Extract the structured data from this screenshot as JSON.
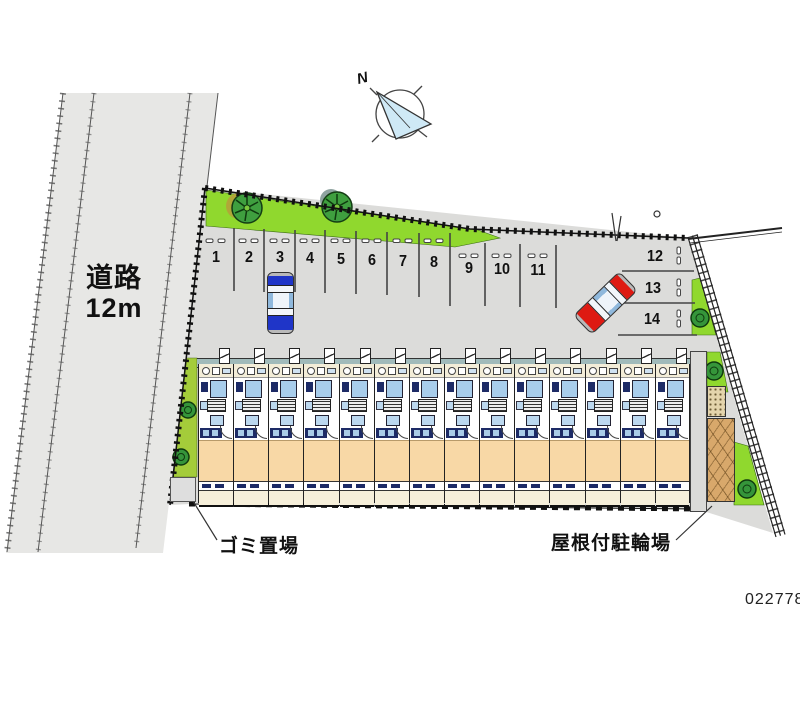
{
  "plan_number": "022778",
  "compass": {
    "north_label": "N"
  },
  "road": {
    "name": "道路",
    "width": "12m"
  },
  "annotations": {
    "garbage": "ゴミ置場",
    "bicycle_parking": "屋根付駐輪場"
  },
  "parking": {
    "vertical_stalls": [
      "1",
      "2",
      "3",
      "4",
      "5",
      "6",
      "7",
      "8",
      "9",
      "10",
      "11"
    ],
    "horizontal_stalls": [
      "12",
      "13",
      "14"
    ],
    "cars": [
      {
        "color_name": "blue",
        "stall": "3"
      },
      {
        "color_name": "red",
        "stall": "aisle near 12-14"
      }
    ]
  },
  "building": {
    "unit_count": 14
  },
  "colors": {
    "lot_gray": "#dcdcda",
    "road_gray": "#e7e7e5",
    "green": "#90d82e",
    "green_strip": "#a4cc3a",
    "tree_dark": "#1f7a1f",
    "walkway_teal": "#a0baba",
    "room_peach": "#f8d8a6",
    "window_blue": "#b9d7ef",
    "kitchen_navy": "#1d2b66",
    "car_blue": "#1f35c8",
    "car_red": "#de1a12",
    "shed_tan": "#d8a86b",
    "compass_fill": "#cfe9f6"
  }
}
